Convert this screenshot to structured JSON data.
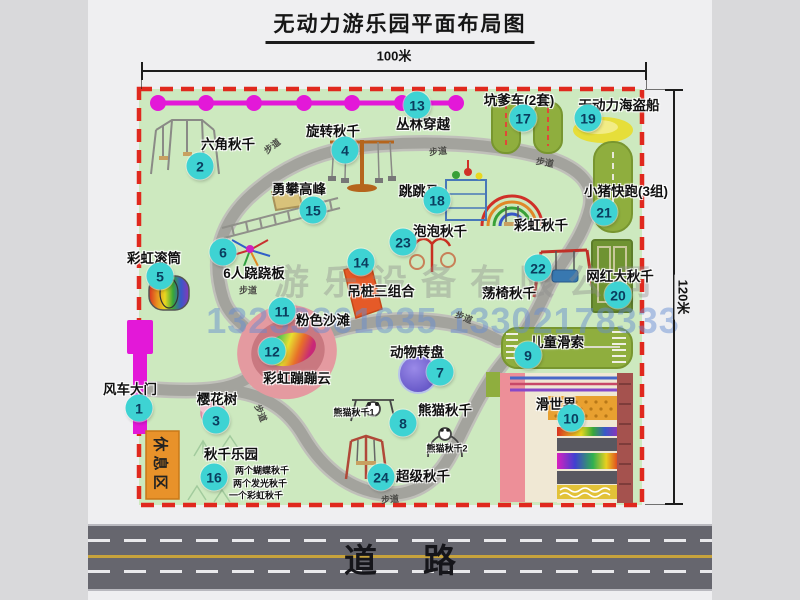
{
  "title": "无动力游乐园平面布局图",
  "dimensions": {
    "top": "100米",
    "right": "120米"
  },
  "watermark": {
    "company": "游乐设备有限公司",
    "phone": "13233861635 13302178333"
  },
  "road": {
    "label": "道路"
  },
  "rest_area": {
    "label": "休息区"
  },
  "markers": [
    {
      "n": "1",
      "x": 139,
      "y": 408
    },
    {
      "n": "2",
      "x": 200,
      "y": 166
    },
    {
      "n": "3",
      "x": 216,
      "y": 420
    },
    {
      "n": "4",
      "x": 345,
      "y": 150
    },
    {
      "n": "5",
      "x": 160,
      "y": 276
    },
    {
      "n": "6",
      "x": 223,
      "y": 252
    },
    {
      "n": "7",
      "x": 440,
      "y": 372
    },
    {
      "n": "8",
      "x": 403,
      "y": 423
    },
    {
      "n": "9",
      "x": 528,
      "y": 355
    },
    {
      "n": "10",
      "x": 571,
      "y": 418
    },
    {
      "n": "11",
      "x": 282,
      "y": 311
    },
    {
      "n": "12",
      "x": 272,
      "y": 351
    },
    {
      "n": "13",
      "x": 417,
      "y": 105
    },
    {
      "n": "14",
      "x": 361,
      "y": 262
    },
    {
      "n": "15",
      "x": 313,
      "y": 210
    },
    {
      "n": "16",
      "x": 214,
      "y": 477
    },
    {
      "n": "17",
      "x": 523,
      "y": 118
    },
    {
      "n": "18",
      "x": 437,
      "y": 200
    },
    {
      "n": "19",
      "x": 588,
      "y": 118
    },
    {
      "n": "20",
      "x": 618,
      "y": 295
    },
    {
      "n": "21",
      "x": 604,
      "y": 212
    },
    {
      "n": "22",
      "x": 538,
      "y": 268
    },
    {
      "n": "23",
      "x": 403,
      "y": 242
    },
    {
      "n": "24",
      "x": 381,
      "y": 477
    }
  ],
  "labels": [
    {
      "text": "六角秋千",
      "x": 228,
      "y": 143
    },
    {
      "text": "旋转秋千",
      "x": 333,
      "y": 130
    },
    {
      "text": "丛林穿越",
      "x": 423,
      "y": 123
    },
    {
      "text": "坑爹车(2套)",
      "x": 519,
      "y": 99
    },
    {
      "text": "无动力海盗船",
      "x": 619,
      "y": 104
    },
    {
      "text": "勇攀高峰",
      "x": 299,
      "y": 188
    },
    {
      "text": "跳跳马",
      "x": 419,
      "y": 190
    },
    {
      "text": "小猪快跑(3组)",
      "x": 626,
      "y": 190
    },
    {
      "text": "彩虹秋千",
      "x": 541,
      "y": 224
    },
    {
      "text": "泡泡秋千",
      "x": 440,
      "y": 230
    },
    {
      "text": "彩虹滚筒",
      "x": 154,
      "y": 257
    },
    {
      "text": "6人跷跷板",
      "x": 254,
      "y": 272
    },
    {
      "text": "吊桩三组合",
      "x": 381,
      "y": 290
    },
    {
      "text": "荡椅秋千",
      "x": 509,
      "y": 292
    },
    {
      "text": "网红大秋千",
      "x": 620,
      "y": 275
    },
    {
      "text": "粉色沙滩",
      "x": 323,
      "y": 319
    },
    {
      "text": "彩虹蹦蹦云",
      "x": 297,
      "y": 377
    },
    {
      "text": "动物转盘",
      "x": 417,
      "y": 351
    },
    {
      "text": "儿童滑索",
      "x": 557,
      "y": 341
    },
    {
      "text": "滑世界",
      "x": 556,
      "y": 403
    },
    {
      "text": "熊猫秋千",
      "x": 445,
      "y": 409
    },
    {
      "text": "超级秋千",
      "x": 423,
      "y": 475
    },
    {
      "text": "风车大门",
      "x": 130,
      "y": 388
    },
    {
      "text": "樱花树",
      "x": 217,
      "y": 398
    },
    {
      "text": "秋千乐园",
      "x": 231,
      "y": 453
    }
  ],
  "small_labels": [
    {
      "text": "熊猫秋千1",
      "x": 354,
      "y": 412
    },
    {
      "text": "熊猫秋千2",
      "x": 447,
      "y": 448
    },
    {
      "text": "两个蝴蝶秋千",
      "x": 262,
      "y": 470
    },
    {
      "text": "两个发光秋千",
      "x": 260,
      "y": 483
    },
    {
      "text": "一个彩虹秋千",
      "x": 256,
      "y": 495
    }
  ],
  "path_labels": [
    {
      "text": "步道",
      "x": 272,
      "y": 146,
      "rot": -38
    },
    {
      "text": "步道",
      "x": 438,
      "y": 151,
      "rot": -6
    },
    {
      "text": "步道",
      "x": 545,
      "y": 162,
      "rot": 10
    },
    {
      "text": "步道",
      "x": 248,
      "y": 290,
      "rot": 0
    },
    {
      "text": "步道",
      "x": 261,
      "y": 413,
      "rot": 68
    },
    {
      "text": "步道",
      "x": 390,
      "y": 499,
      "rot": -5
    },
    {
      "text": "步道",
      "x": 464,
      "y": 317,
      "rot": 22
    }
  ]
}
